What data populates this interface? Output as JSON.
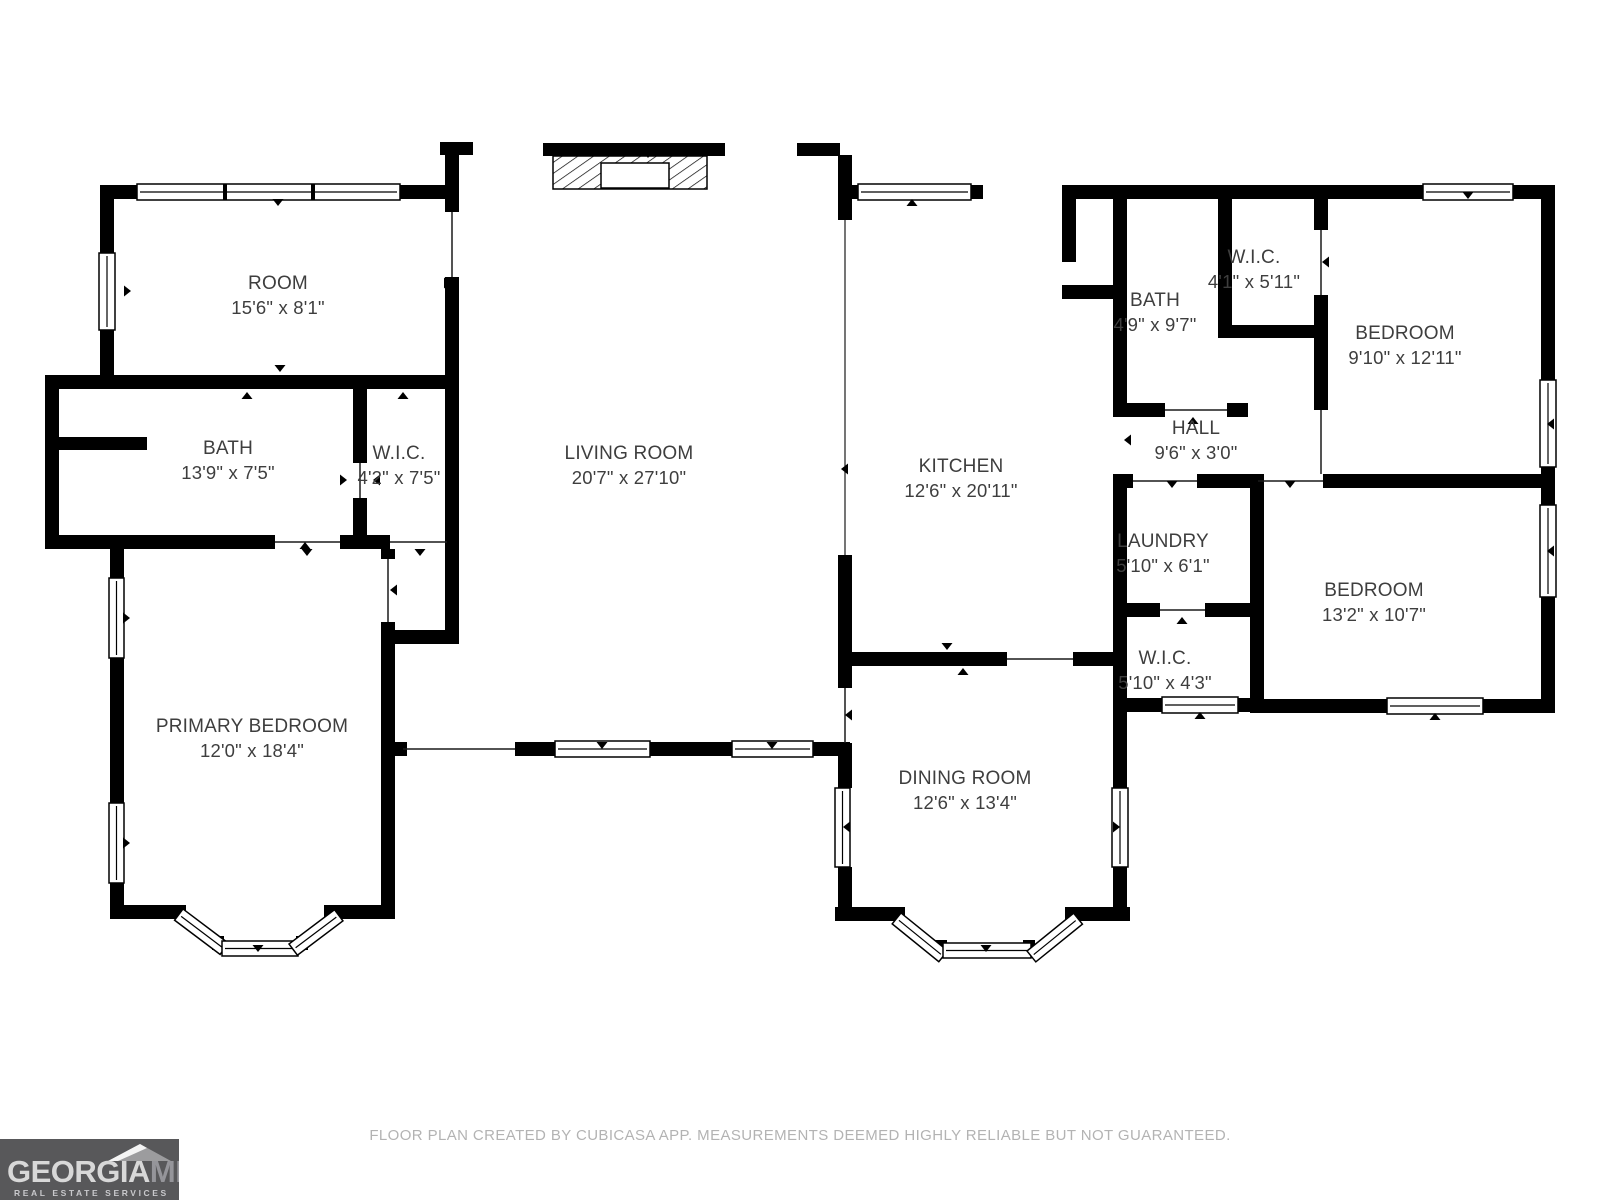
{
  "floor_plan": {
    "rooms": [
      {
        "id": "room",
        "name": "ROOM",
        "dims": "15'6\" x 8'1\""
      },
      {
        "id": "bath-1",
        "name": "BATH",
        "dims": "13'9\" x 7'5\""
      },
      {
        "id": "wic-1",
        "name": "W.I.C.",
        "dims": "4'2\" x 7'5\""
      },
      {
        "id": "living-room",
        "name": "LIVING ROOM",
        "dims": "20'7\" x 27'10\""
      },
      {
        "id": "primary-bedroom",
        "name": "PRIMARY BEDROOM",
        "dims": "12'0\" x 18'4\""
      },
      {
        "id": "kitchen",
        "name": "KITCHEN",
        "dims": "12'6\" x 20'11\""
      },
      {
        "id": "dining-room",
        "name": "DINING ROOM",
        "dims": "12'6\" x 13'4\""
      },
      {
        "id": "bath-2",
        "name": "BATH",
        "dims": "4'9\" x 9'7\""
      },
      {
        "id": "wic-2",
        "name": "W.I.C.",
        "dims": "4'1\" x 5'11\""
      },
      {
        "id": "bedroom-1",
        "name": "BEDROOM",
        "dims": "9'10\" x 12'11\""
      },
      {
        "id": "hall",
        "name": "HALL",
        "dims": "9'6\" x 3'0\""
      },
      {
        "id": "laundry",
        "name": "LAUNDRY",
        "dims": "5'10\" x 6'1\""
      },
      {
        "id": "wic-3",
        "name": "W.I.C.",
        "dims": "5'10\" x 4'3\""
      },
      {
        "id": "bedroom-2",
        "name": "BEDROOM",
        "dims": "13'2\" x 10'7\""
      }
    ]
  },
  "footer": {
    "disclaimer": "FLOOR PLAN CREATED BY CUBICASA APP. MEASUREMENTS DEEMED HIGHLY RELIABLE BUT NOT GUARANTEED."
  },
  "logo": {
    "brand": "GEORGIA",
    "brand_suffix": "MLS",
    "tagline": "REAL ESTATE SERVICES"
  },
  "colors": {
    "wall": "#000000",
    "label_text": "#3e3e3e",
    "footer_text": "#b3b3b3",
    "logo_bg": "#58585a",
    "logo_brand": "#d8d8d8",
    "logo_suffix": "#95959a"
  }
}
